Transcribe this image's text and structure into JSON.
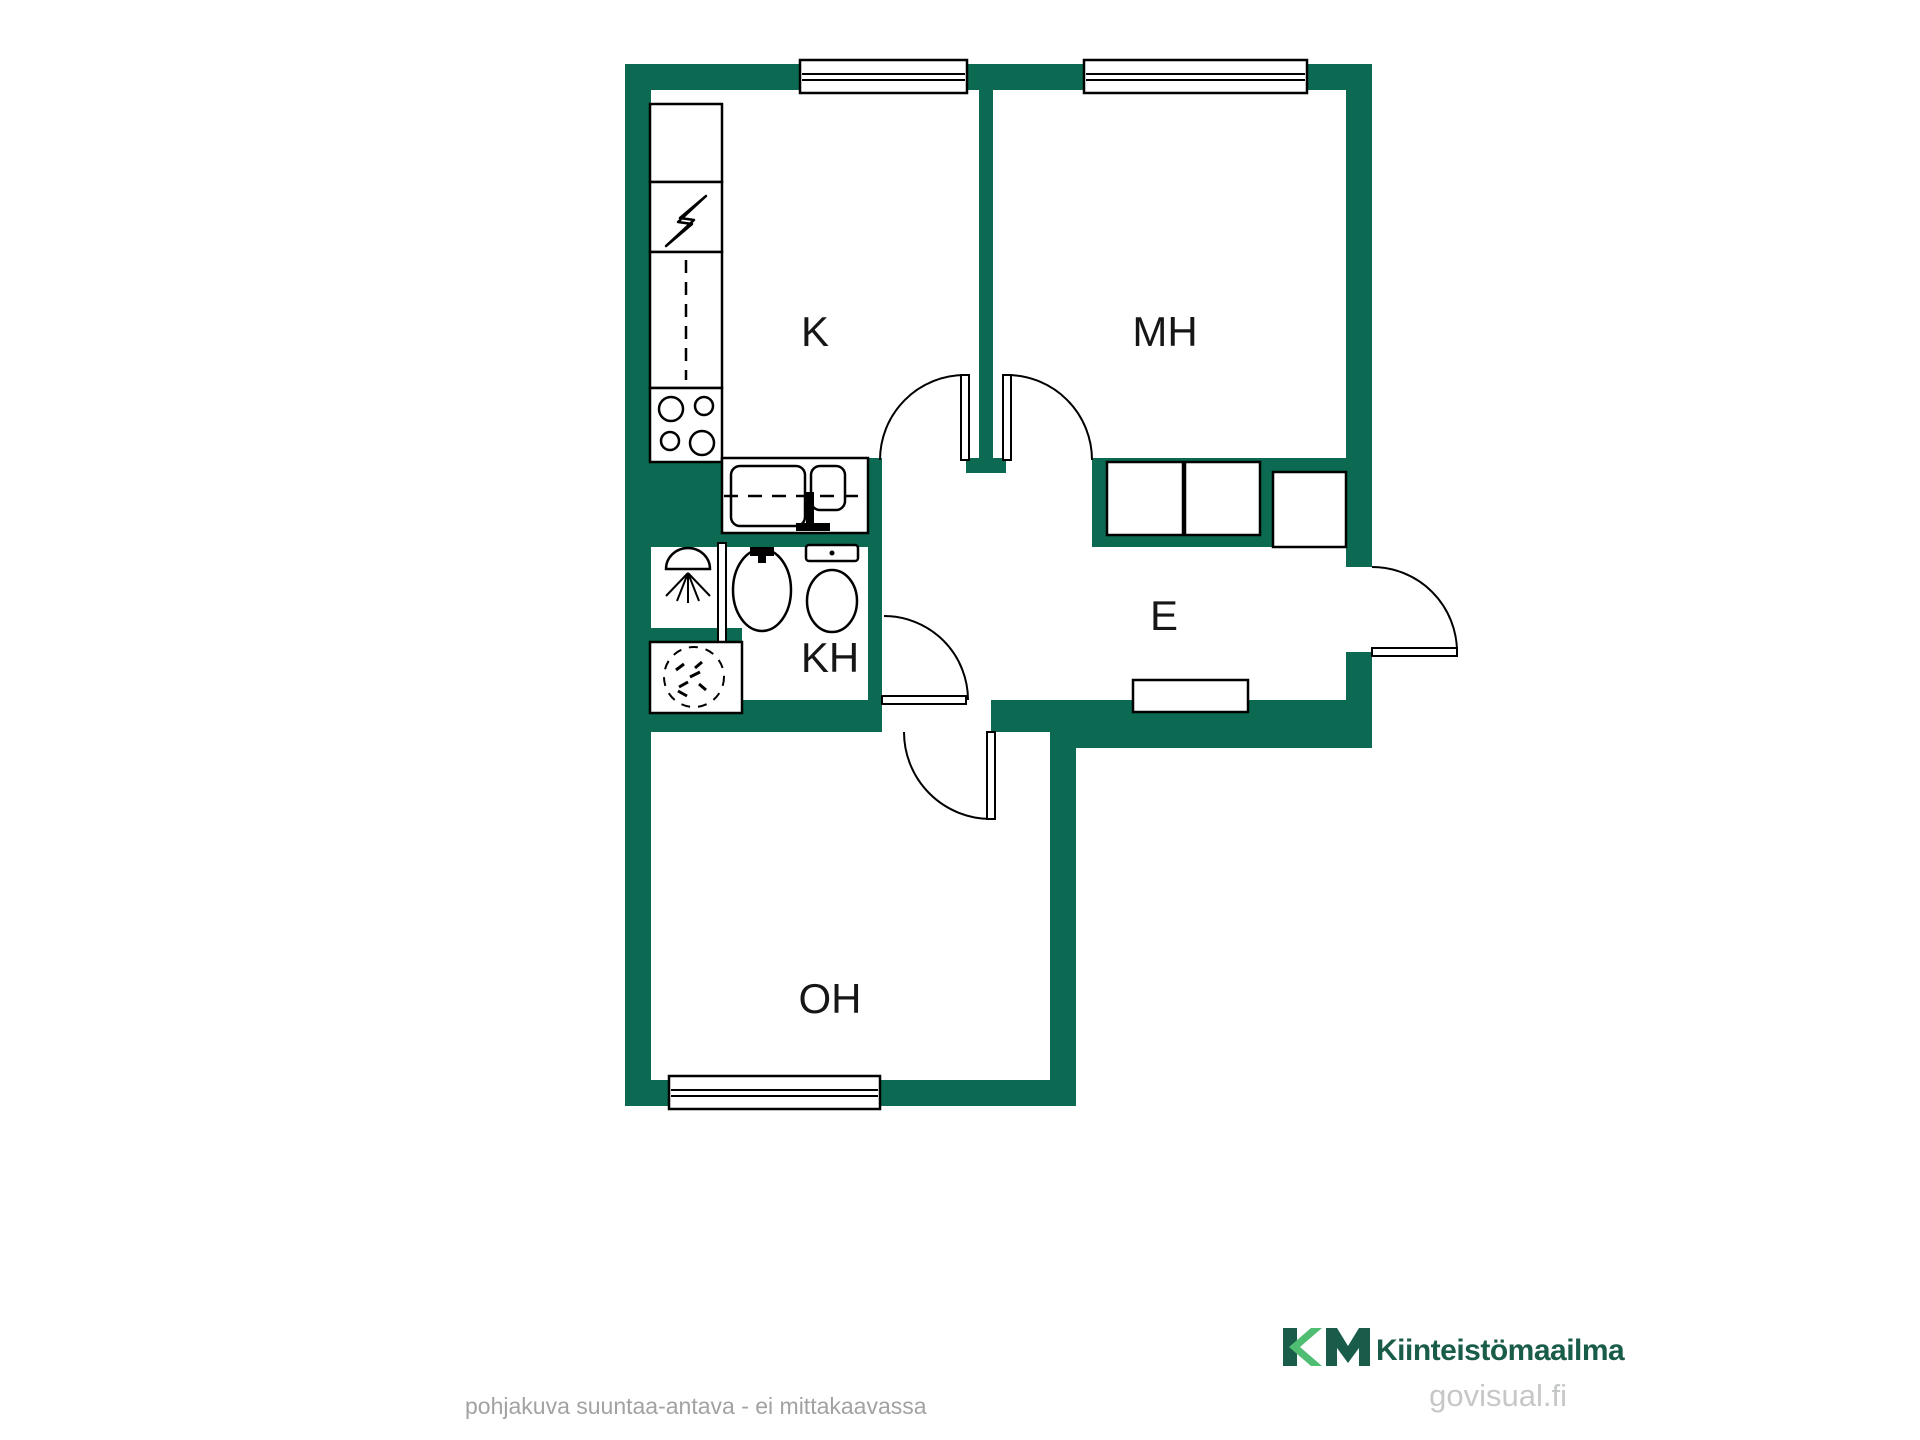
{
  "plan": {
    "type": "apartment-floor-plan",
    "rooms": [
      {
        "id": "kitchen",
        "label": "K"
      },
      {
        "id": "bedroom",
        "label": "MH"
      },
      {
        "id": "hallway",
        "label": "E"
      },
      {
        "id": "bathroom",
        "label": "KH"
      },
      {
        "id": "living-room",
        "label": "OH"
      }
    ],
    "fixtures": [
      {
        "name": "fridge"
      },
      {
        "name": "electric-panel-lightning-icon"
      },
      {
        "name": "kitchen-counter-dashed"
      },
      {
        "name": "stove-4-burners"
      },
      {
        "name": "kitchen-sink-double-basin"
      },
      {
        "name": "shower-head-icon"
      },
      {
        "name": "shower-screen"
      },
      {
        "name": "washbasin"
      },
      {
        "name": "toilet"
      },
      {
        "name": "washing-machine"
      },
      {
        "name": "wardrobe-1"
      },
      {
        "name": "wardrobe-2"
      },
      {
        "name": "closet"
      },
      {
        "name": "shoe-cabinet"
      }
    ],
    "windows_count": 3,
    "doors_count": 5
  },
  "colors": {
    "wall": "#0B6A51",
    "outline": "#000000",
    "logo_dark": "#195C49",
    "logo_light": "#4FBE73",
    "disclaimer_text": "#A2A2A2",
    "watermark_text": "#C5C7C8"
  },
  "branding": {
    "logo_initials": "KM",
    "logo_name": "Kiinteistömaailma",
    "watermark": "govisual.fi"
  },
  "footer": {
    "disclaimer": "pohjakuva suuntaa-antava - ei mittakaavassa"
  }
}
